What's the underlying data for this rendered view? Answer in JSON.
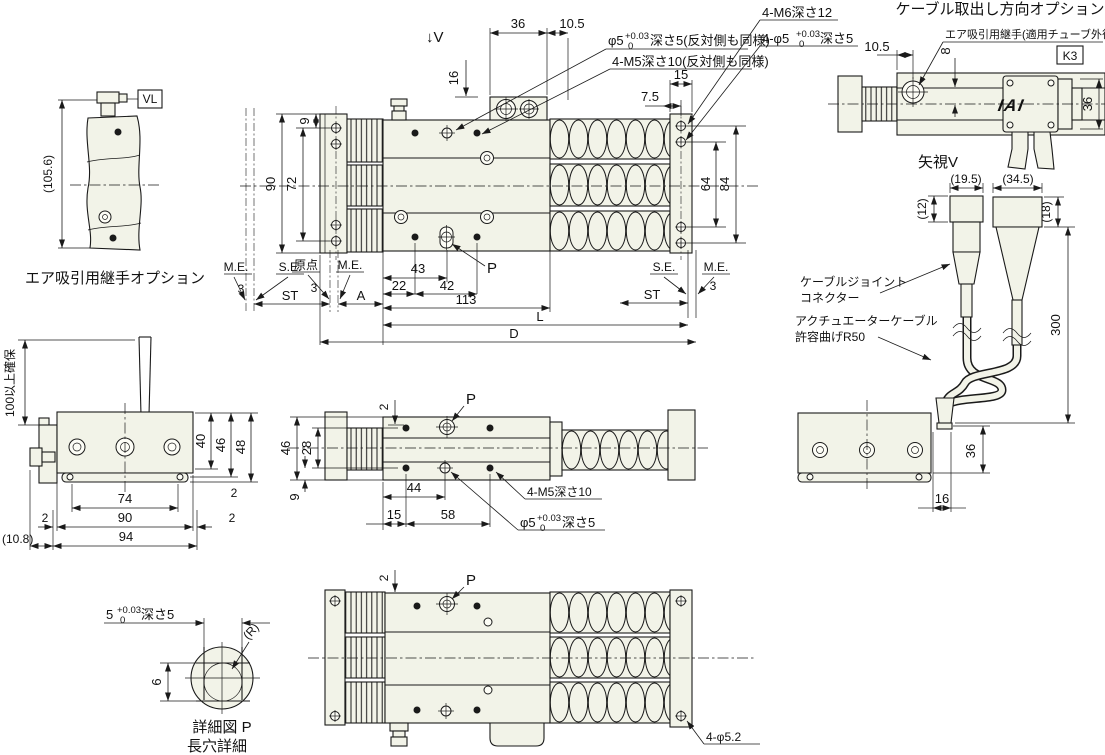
{
  "colors": {
    "line": "#1a1a1a",
    "body_fill": "#f2f3e8",
    "background": "#ffffff"
  },
  "air_fitting": {
    "height": "(105.6)",
    "vl": "VL",
    "caption": "エア吸引用継手オプション"
  },
  "top_view": {
    "view_arrow": "↓V",
    "d36": "36",
    "d10_5": "10.5",
    "d16": "16",
    "d7_5": "7.5",
    "d15": "15",
    "d9": "9",
    "d72": "72",
    "d90": "90",
    "d64": "64",
    "d84": "84",
    "phi5_prefix": "φ5",
    "phi5_tol_top": "+0.03",
    "phi5_tol_bot": "0",
    "phi5_suffix": "深さ5(反対側も同様)",
    "m5_note": "4-M5深さ10(反対側も同様)",
    "m6_note": "4-M6深さ12",
    "phi5b_prefix": "4-φ5",
    "phi5b_tol_top": "+0.03",
    "phi5b_tol_bot": "0",
    "phi5b_suffix": "深さ5",
    "p": "P",
    "me1": "M.E.",
    "g3_1": "3",
    "se1": "S.E.",
    "origin": "原点",
    "g3_2": "3",
    "me2": "M.E.",
    "st1": "ST",
    "a": "A",
    "d22": "22",
    "d43": "43",
    "d42": "42",
    "d113": "113",
    "l": "L",
    "d": "D",
    "se2": "S.E.",
    "me3": "M.E.",
    "g3_3": "3",
    "st2": "ST"
  },
  "k3_view": {
    "title": "ケーブル取出し方向オプション",
    "fitting_note": "エア吸引用継手(適用チューブ外径φ6)",
    "d10_5": "10.5",
    "d8": "8",
    "k3": "K3",
    "logo": "IAI",
    "d36": "36",
    "caption": "矢視V"
  },
  "cable_view": {
    "d19_5": "(19.5)",
    "d34_5": "(34.5)",
    "d12": "(12)",
    "d18": "(18)",
    "d300": "300",
    "joint_l1": "ケーブルジョイント",
    "joint_l2": "コネクター",
    "cable_l1": "アクチュエーターケーブル",
    "cable_l2": "許容曲げR50"
  },
  "base_view": {
    "d36": "36",
    "d16": "16"
  },
  "left_view": {
    "clearance": "100以上確保",
    "d40": "40",
    "d46": "46",
    "d48": "48",
    "g2a": "2",
    "d74": "74",
    "g2b": "2",
    "d90": "90",
    "g2c": "2",
    "d94": "94",
    "d10_8": "(10.8)"
  },
  "center_view": {
    "d46": "46",
    "d28": "28",
    "d9": "9",
    "d2": "2",
    "p": "P",
    "d44": "44",
    "d15": "15",
    "d58": "58",
    "m5_note": "4-M5深さ10",
    "phi5_prefix": "φ5",
    "phi5_tol_top": "+0.03",
    "phi5_tol_bot": "0",
    "phi5_suffix": "深さ5"
  },
  "detail_view": {
    "w_prefix": "5",
    "w_tol_top": "+0.03",
    "w_tol_bot": "0",
    "w_suffix": "深さ5",
    "r": "(R)",
    "d6": "6",
    "caption1": "詳細図 P",
    "caption2": "長穴詳細"
  },
  "bottom_view": {
    "d2": "2",
    "p": "P",
    "holes": "4-φ5.2"
  }
}
